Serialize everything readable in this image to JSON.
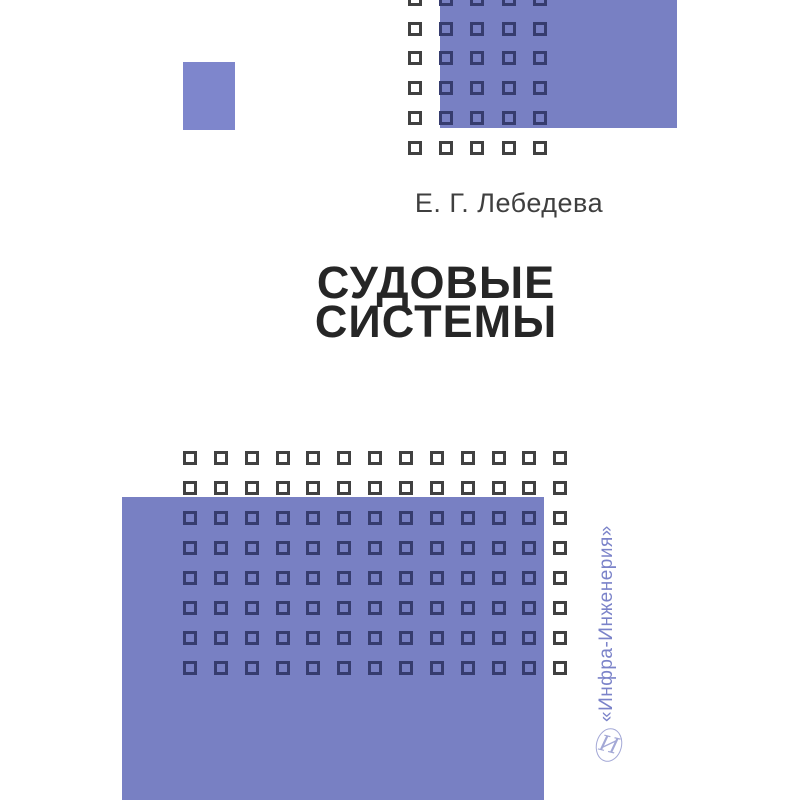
{
  "cover": {
    "author": "Е. Г. Лебедева",
    "title_lines": [
      "СУДОВЫЕ",
      "СИСТЕМЫ"
    ],
    "publisher": "«Инфра-Инженерия»",
    "publisher_logo_glyph": "И"
  },
  "colors": {
    "background": "#ffffff",
    "periwinkle": "#7880c3",
    "periwinkle_light": "#7e86cc",
    "square_border_gray": "#414141",
    "square_border_navy": "#363c6e",
    "title_text": "#262626",
    "author_text": "#3f3f3f",
    "publisher_text": "#7b83c9",
    "logo_faint": "#a3a8d6"
  },
  "decor": {
    "rects": [
      {
        "name": "small-accent-rect",
        "x": 183,
        "y": 62,
        "w": 52,
        "h": 68,
        "color": "periwinkle_light"
      },
      {
        "name": "top-right-accent-rect",
        "x": 440,
        "y": 0,
        "w": 237,
        "h": 128,
        "color": "periwinkle"
      },
      {
        "name": "bottom-accent-rect",
        "x": 122,
        "y": 497,
        "w": 422,
        "h": 303,
        "color": "periwinkle"
      }
    ],
    "grids": [
      {
        "name": "top-square-grid",
        "origin_x": 415,
        "origin_y": -1,
        "cols": 5,
        "rows": 6,
        "dx": 31.2,
        "dy": 29.7,
        "size": 14,
        "border_on_blue": "square_border_navy",
        "border_on_white": "square_border_gray"
      },
      {
        "name": "bottom-square-grid",
        "origin_x": 190,
        "origin_y": 458,
        "cols": 13,
        "rows": 8,
        "dx": 30.85,
        "dy": 30,
        "size": 14,
        "border_on_blue": "square_border_navy",
        "border_on_white": "square_border_gray"
      }
    ]
  }
}
